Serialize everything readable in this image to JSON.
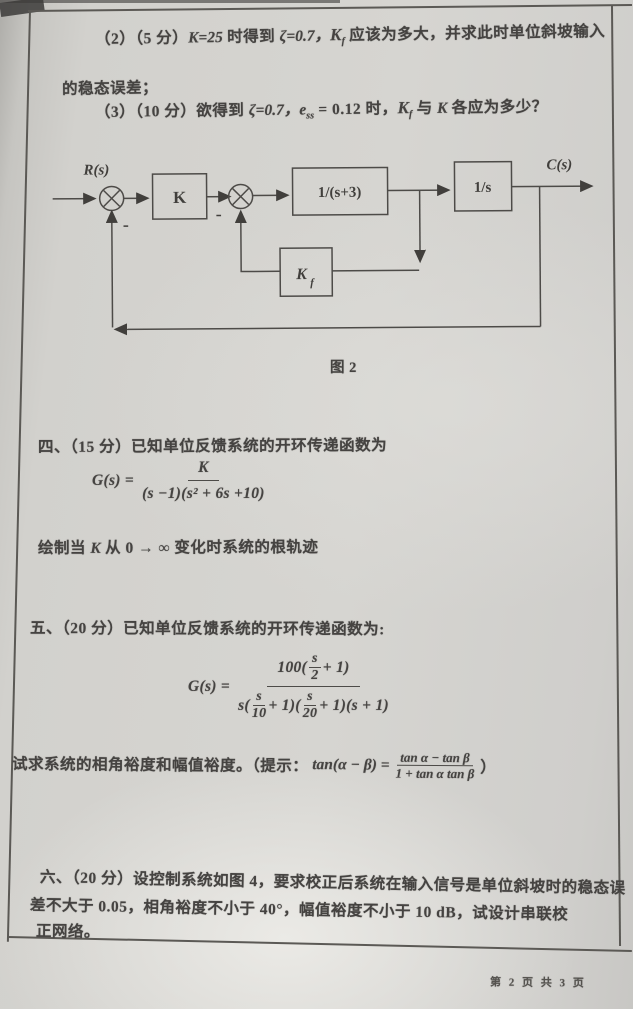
{
  "appearance": {
    "paper": "#d5d4d0",
    "ink": "#454341",
    "line": "#55534f"
  },
  "problem2": {
    "line1": {
      "prefix": "（2）（5 分）",
      "k_eq": "K=25",
      "mid1": " 时得到 ",
      "zeta": "ζ=0.7，",
      "kf_K": "K",
      "kf_f": "f",
      "rest": " 应该为多大，并求此时单位斜坡输入"
    },
    "line2": "的稳态误差；",
    "line3": {
      "prefix": "（3）（10 分）欲得到 ",
      "zeta": "ζ=0.7，",
      "e": "e",
      "e_sub": "ss",
      "e_eq": " = 0.12 时，",
      "kf_K": "K",
      "kf_f": "f",
      "mid": " 与 ",
      "k2": "K",
      "tail": " 各应为多少？"
    }
  },
  "diagram": {
    "r_label": "R(s)",
    "c_label": "C(s)",
    "block_k": "K",
    "block_g1": "1/(s+3)",
    "block_g2": "1/s",
    "block_kf_main": "K",
    "block_kf_sub": "f",
    "minus_outer": "-",
    "minus_inner": "-",
    "caption": "图 2"
  },
  "problem4": {
    "heading": "四、（15 分）已知单位反馈系统的开环传递函数为",
    "formula": {
      "lhs": "G(s) =",
      "num": "K",
      "den": "(s −1)(s² + 6s +10)"
    },
    "note": {
      "p1": "绘制当 ",
      "k": "K",
      "p2": " 从 0 → ∞ 变化时系统的根轨迹"
    }
  },
  "problem5": {
    "heading": "五、（20 分）已知单位反馈系统的开环传递函数为:",
    "formula": {
      "lhs": "G(s) =",
      "num": {
        "pre": "100(",
        "f1top": "s",
        "f1bot": "2",
        "post": " + 1)"
      },
      "den": {
        "pre": "s(",
        "f1top": "s",
        "f1bot": "10",
        "mid1": " + 1)(",
        "f2top": "s",
        "f2bot": "20",
        "mid2": " + 1)(s + 1)"
      }
    },
    "note": {
      "p1": "试求系统的相角裕度和幅值裕度。（提示：",
      "tan_lhs": "tan(α − β) =",
      "frac_top": "tan α − tan β",
      "frac_bot": "1 + tan α tan β",
      "close": "）"
    }
  },
  "problem6": {
    "line1": "六、（20 分）设控制系统如图 4，要求校正后系统在输入信号是单位斜坡时的稳态误",
    "line2": "差不大于 0.05，相角裕度不小于 40°，幅值裕度不小于 10 dB，试设计串联校",
    "line3": "正网络。"
  },
  "footer": {
    "page_label": "第 2 页 共 3 页"
  }
}
